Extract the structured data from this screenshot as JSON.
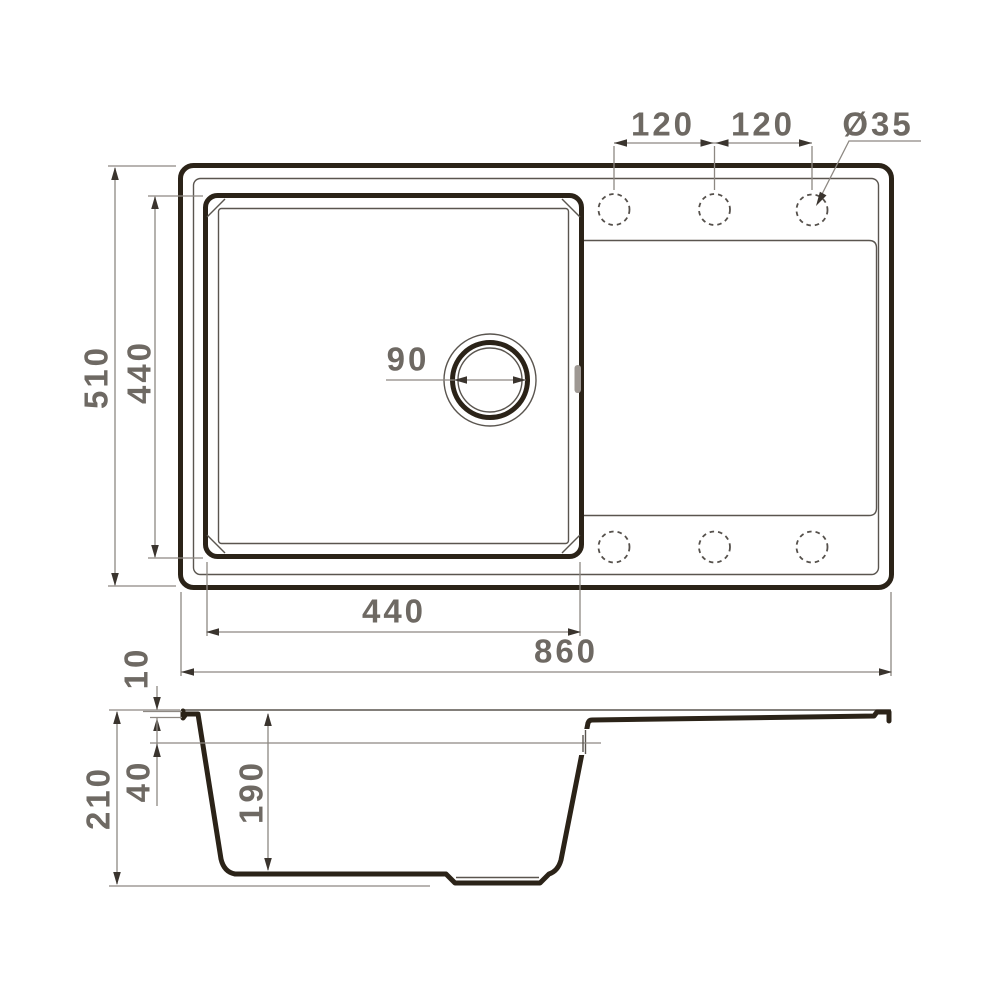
{
  "drawing": {
    "type": "sink-technical-drawing",
    "views": [
      "top-view",
      "section-view"
    ]
  },
  "colors": {
    "outline": "#2b2318",
    "thin_line": "#5a554f",
    "dim_line": "#8d8882",
    "arrow": "#3a342e",
    "label_text": "#6e6963",
    "overflow_slot": "#9e9893",
    "background": "#ffffff"
  },
  "top_view": {
    "width_total": "860",
    "depth_total": "510",
    "bowl_width": "440",
    "bowl_depth": "440",
    "drain_diameter": "90",
    "hole_spacing_left": "120",
    "hole_spacing_right": "120",
    "hole_diameter": "Ø35",
    "tap_holes_top_count": 3,
    "tap_holes_bottom_count": 3
  },
  "section_view": {
    "height_total": "210",
    "bowl_inner_depth": "190",
    "overflow_offset": "40",
    "rim_thickness": "10"
  }
}
